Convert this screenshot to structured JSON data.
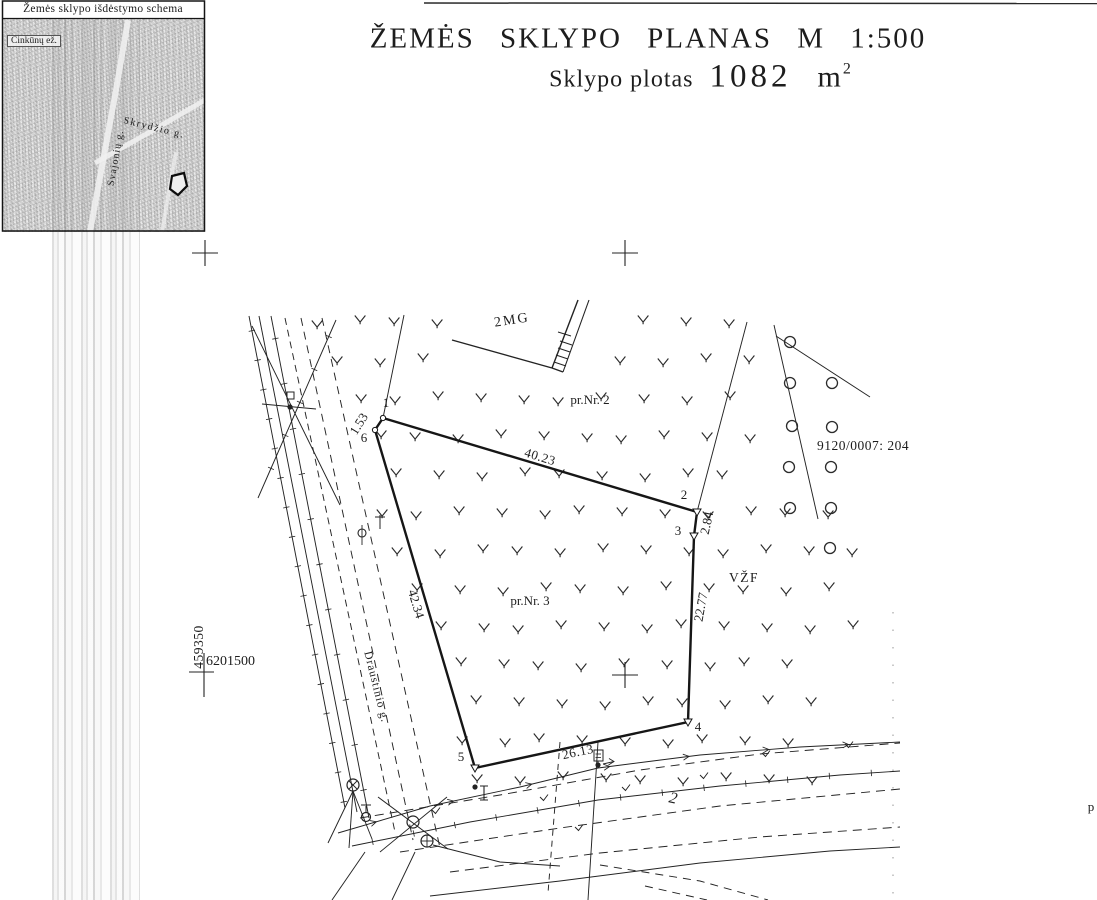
{
  "inset": {
    "title": "Žemės sklypo išdėstymo schema",
    "lake_label": "Cinkūnų ež.",
    "streets": {
      "skrydzio": "Skrydžio g.",
      "svajoniu": "Svajonių g."
    }
  },
  "title_block": {
    "line1": "ŽEMĖS SKLYPO PLANAS M 1:500",
    "area_label": "Sklypo plotas",
    "area_value": "1082",
    "area_unit": "m",
    "area_exponent": "2"
  },
  "grid_coordinates": {
    "vertical": "459350",
    "horizontal": "6201500"
  },
  "plan": {
    "building_label": "2MG",
    "parcel_north": "pr.Nr. 2",
    "parcel_main": "pr.Nr. 3",
    "right_area_label": "VŽF",
    "cadastral_number": "9120/0007: 204",
    "street_name": "Draustinio g.",
    "handwritten_mark": "2",
    "edge_text": "p",
    "vertex_labels": [
      "1",
      "2",
      "3",
      "4",
      "5",
      "6"
    ],
    "side_lengths": {
      "s6_1": "1.53",
      "s1_2": "40.23",
      "s2_3": "2.84",
      "s3_4": "22.77",
      "s4_5": "26.13",
      "s5_6": "42.34"
    }
  }
}
